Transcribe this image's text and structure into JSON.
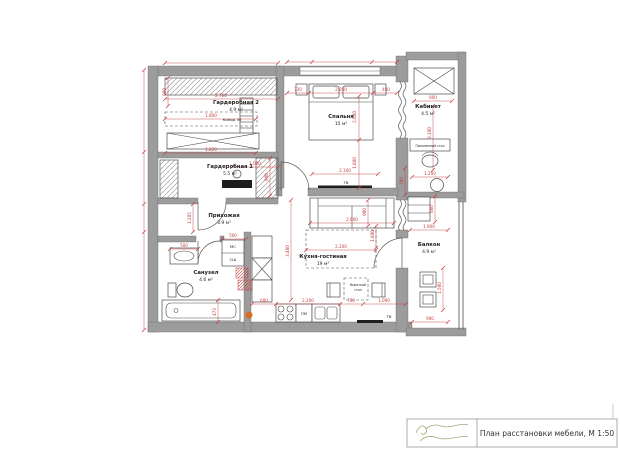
{
  "colors": {
    "dimension_red": "#c43c3c",
    "wall_gray": "#9c9c9c",
    "logo_olive": "#a4aa78",
    "accent_orange": "#d96e1f"
  },
  "title_block": {
    "caption": "План расстановки мебели, М 1:50"
  },
  "rooms": [
    {
      "name": "Гардеробная 2",
      "area": "4.9 м²"
    },
    {
      "name": "Гардеробная 1",
      "area": "5.5 м²"
    },
    {
      "name": "Спальня",
      "area": "15 м²"
    },
    {
      "name": "Кабинет",
      "area": "4.5 м²"
    },
    {
      "name": "Прихожая",
      "area": "3.9 м²"
    },
    {
      "name": "Санузел",
      "area": "4.6 м²"
    },
    {
      "name": "Кухня-гостиная",
      "area": "19 м²"
    },
    {
      "name": "Балкон",
      "area": "4.9 м²"
    }
  ],
  "furniture_labels": {
    "tv_bedroom": "ТВ",
    "tv_living": "ТВ",
    "washer": "МС",
    "dryer": "СШ",
    "dishwasher": "ПМ",
    "komod": "Комод 50",
    "pullout_l1": "Выкатной",
    "pullout_l2": "стол",
    "desk": "Письменный стол"
  },
  "dimensions": [
    {
      "v": "2.700",
      "x": 221,
      "y": 97,
      "r": 0
    },
    {
      "v": "900",
      "x": 166,
      "y": 92,
      "r": -90
    },
    {
      "v": "1.800",
      "x": 211,
      "y": 117,
      "r": 0
    },
    {
      "v": "1.820",
      "x": 211,
      "y": 151,
      "r": 0
    },
    {
      "v": "1.000",
      "x": 255,
      "y": 165,
      "r": 0
    },
    {
      "v": "900",
      "x": 268,
      "y": 177,
      "r": -90
    },
    {
      "v": "720",
      "x": 298,
      "y": 91,
      "r": 0
    },
    {
      "v": "2.050",
      "x": 341,
      "y": 91,
      "r": 0
    },
    {
      "v": "450",
      "x": 386,
      "y": 91,
      "r": 0
    },
    {
      "v": "2.000",
      "x": 356,
      "y": 117,
      "r": -90
    },
    {
      "v": "1.600",
      "x": 356,
      "y": 163,
      "r": -90
    },
    {
      "v": "2.100",
      "x": 345,
      "y": 172,
      "r": 0
    },
    {
      "v": "900",
      "x": 433,
      "y": 99,
      "r": 0
    },
    {
      "v": "3.100",
      "x": 431,
      "y": 133,
      "r": -90
    },
    {
      "v": "1.200",
      "x": 430,
      "y": 175,
      "r": 0
    },
    {
      "v": "700",
      "x": 403,
      "y": 181,
      "r": -90
    },
    {
      "v": "800",
      "x": 433,
      "y": 209,
      "r": -90
    },
    {
      "v": "1.900",
      "x": 429,
      "y": 228,
      "r": 0
    },
    {
      "v": "1.500",
      "x": 441,
      "y": 288,
      "r": -90
    },
    {
      "v": "900",
      "x": 430,
      "y": 320,
      "r": 0
    },
    {
      "v": "2.600",
      "x": 352,
      "y": 221,
      "r": 0
    },
    {
      "v": "900",
      "x": 366,
      "y": 212,
      "r": -90
    },
    {
      "v": "1.600",
      "x": 374,
      "y": 236,
      "r": -90
    },
    {
      "v": "2.200",
      "x": 341,
      "y": 248,
      "r": 0
    },
    {
      "v": "3.480",
      "x": 289,
      "y": 251,
      "r": -90
    },
    {
      "v": "600",
      "x": 264,
      "y": 302,
      "r": 0
    },
    {
      "v": "2.200",
      "x": 308,
      "y": 302,
      "r": 0
    },
    {
      "v": "700",
      "x": 351,
      "y": 302,
      "r": 0
    },
    {
      "v": "1.090",
      "x": 384,
      "y": 302,
      "r": 0
    },
    {
      "v": "500",
      "x": 233,
      "y": 237,
      "r": 0
    },
    {
      "v": "500",
      "x": 184,
      "y": 247,
      "r": 0
    },
    {
      "v": "1.205",
      "x": 191,
      "y": 218,
      "r": -90
    },
    {
      "v": "473",
      "x": 216,
      "y": 312,
      "r": -90
    }
  ]
}
